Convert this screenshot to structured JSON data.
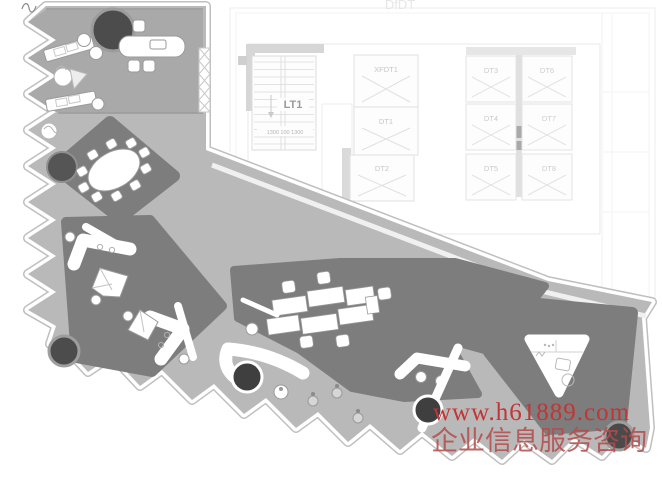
{
  "document": {
    "type": "interior design floor plan over CAD base drawing"
  },
  "core": {
    "stair_label": "LT1",
    "stair_dimension": "1300 100 1300",
    "faint_header_text": "DfDT",
    "elevators": {
      "xfdt1": "XFDT1",
      "dt1": "DT1",
      "dt2": "DT2",
      "dt3": "DT3",
      "dt4": "DT4",
      "dt5": "DT5",
      "dt6": "DT6",
      "dt7": "DT7",
      "dt8": "DT8"
    }
  },
  "watermark": {
    "url_line": "www.h61889.com",
    "caption_line": "企业信息服务咨询"
  },
  "colors": {
    "plate_gray": "#b9b9b9",
    "room_floor_gray": "#a9a9a9",
    "dark_zone_gray": "#7d7d7d",
    "planter_dark": "#4c4c4c",
    "cad_line": "#e3e3e3",
    "cad_label": "#c6c6c6",
    "watermark_red": "#c23535"
  }
}
